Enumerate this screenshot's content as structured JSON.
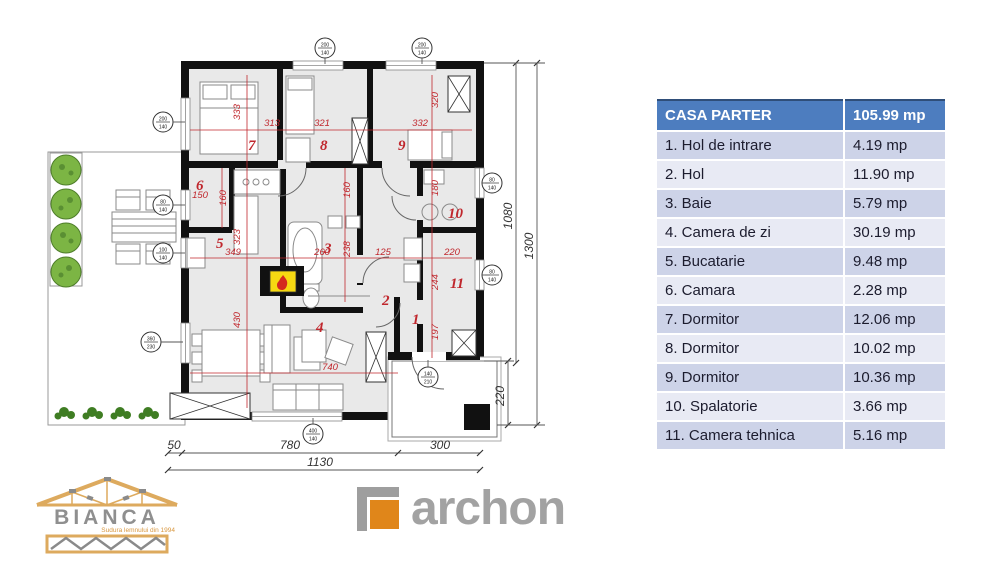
{
  "table": {
    "header": {
      "label": "CASA PARTER",
      "value": "105.99 mp"
    },
    "rows": [
      {
        "label": "1. Hol de intrare",
        "value": "4.19 mp"
      },
      {
        "label": "2. Hol",
        "value": "11.90 mp"
      },
      {
        "label": "3. Baie",
        "value": "5.79 mp"
      },
      {
        "label": "4. Camera de zi",
        "value": "30.19 mp"
      },
      {
        "label": "5. Bucatarie",
        "value": "9.48 mp"
      },
      {
        "label": "6. Camara",
        "value": "2.28 mp"
      },
      {
        "label": "7. Dormitor",
        "value": "12.06 mp"
      },
      {
        "label": "8. Dormitor",
        "value": "10.02 mp"
      },
      {
        "label": "9. Dormitor",
        "value": "10.36 mp"
      },
      {
        "label": "10. Spalatorie",
        "value": "3.66 mp"
      },
      {
        "label": "11. Camera tehnica",
        "value": "5.16 mp"
      }
    ]
  },
  "plan": {
    "room_numbers": [
      {
        "n": "7",
        "x": 248,
        "y": 150
      },
      {
        "n": "8",
        "x": 320,
        "y": 150
      },
      {
        "n": "9",
        "x": 398,
        "y": 150
      },
      {
        "n": "6",
        "x": 196,
        "y": 190
      },
      {
        "n": "5",
        "x": 216,
        "y": 248
      },
      {
        "n": "3",
        "x": 324,
        "y": 253
      },
      {
        "n": "10",
        "x": 448,
        "y": 218
      },
      {
        "n": "11",
        "x": 450,
        "y": 288
      },
      {
        "n": "2",
        "x": 382,
        "y": 305
      },
      {
        "n": "1",
        "x": 412,
        "y": 324
      },
      {
        "n": "4",
        "x": 316,
        "y": 332
      }
    ],
    "dim_labels": [
      {
        "t": "313",
        "x": 272,
        "y": 126
      },
      {
        "t": "321",
        "x": 322,
        "y": 126
      },
      {
        "t": "332",
        "x": 420,
        "y": 126
      },
      {
        "t": "333",
        "x": 240,
        "y": 112,
        "r": -90
      },
      {
        "t": "320",
        "x": 438,
        "y": 100,
        "r": -90
      },
      {
        "t": "150",
        "x": 200,
        "y": 198
      },
      {
        "t": "160",
        "x": 226,
        "y": 198,
        "r": -90
      },
      {
        "t": "160",
        "x": 350,
        "y": 190,
        "r": -90
      },
      {
        "t": "180",
        "x": 438,
        "y": 188,
        "r": -90
      },
      {
        "t": "323",
        "x": 240,
        "y": 237,
        "r": -90
      },
      {
        "t": "349",
        "x": 233,
        "y": 255
      },
      {
        "t": "260",
        "x": 322,
        "y": 255
      },
      {
        "t": "238",
        "x": 350,
        "y": 249,
        "r": -90
      },
      {
        "t": "125",
        "x": 383,
        "y": 255
      },
      {
        "t": "220",
        "x": 452,
        "y": 255
      },
      {
        "t": "244",
        "x": 438,
        "y": 282,
        "r": -90
      },
      {
        "t": "430",
        "x": 240,
        "y": 320,
        "r": -90
      },
      {
        "t": "197",
        "x": 438,
        "y": 332,
        "r": -90
      },
      {
        "t": "740",
        "x": 330,
        "y": 370
      }
    ],
    "window_tags": [
      {
        "top": "200",
        "bot": "140",
        "x": 325,
        "y": 48
      },
      {
        "top": "200",
        "bot": "140",
        "x": 422,
        "y": 48
      },
      {
        "top": "200",
        "bot": "140",
        "x": 163,
        "y": 122
      },
      {
        "top": "80",
        "bot": "140",
        "x": 163,
        "y": 205
      },
      {
        "top": "100",
        "bot": "140",
        "x": 163,
        "y": 253
      },
      {
        "top": "360",
        "bot": "230",
        "x": 151,
        "y": 342
      },
      {
        "top": "400",
        "bot": "140",
        "x": 313,
        "y": 434
      },
      {
        "top": "80",
        "bot": "140",
        "x": 492,
        "y": 183
      },
      {
        "top": "80",
        "bot": "140",
        "x": 492,
        "y": 275
      },
      {
        "top": "140",
        "bot": "210",
        "x": 428,
        "y": 377
      }
    ],
    "outer_dims": {
      "d50": "50",
      "d780": "780",
      "d300": "300",
      "d1130": "1130",
      "d1080": "1080",
      "d1300": "1300",
      "d220": "220"
    }
  },
  "logos": {
    "bianca": {
      "name": "BIANCA",
      "tagline": "Sudura lemnului din 1994"
    },
    "archon": {
      "name": "archon"
    }
  },
  "colors": {
    "table_header": "#4d7dbf",
    "row_odd": "#cdd3e8",
    "row_even": "#e8eaf4",
    "plan_red": "#c0272d",
    "fireplace_yellow": "#f6d912",
    "tree_green": "#7cb544",
    "archon_orange": "#e0861a",
    "wood_tan": "#ddaa5e"
  }
}
